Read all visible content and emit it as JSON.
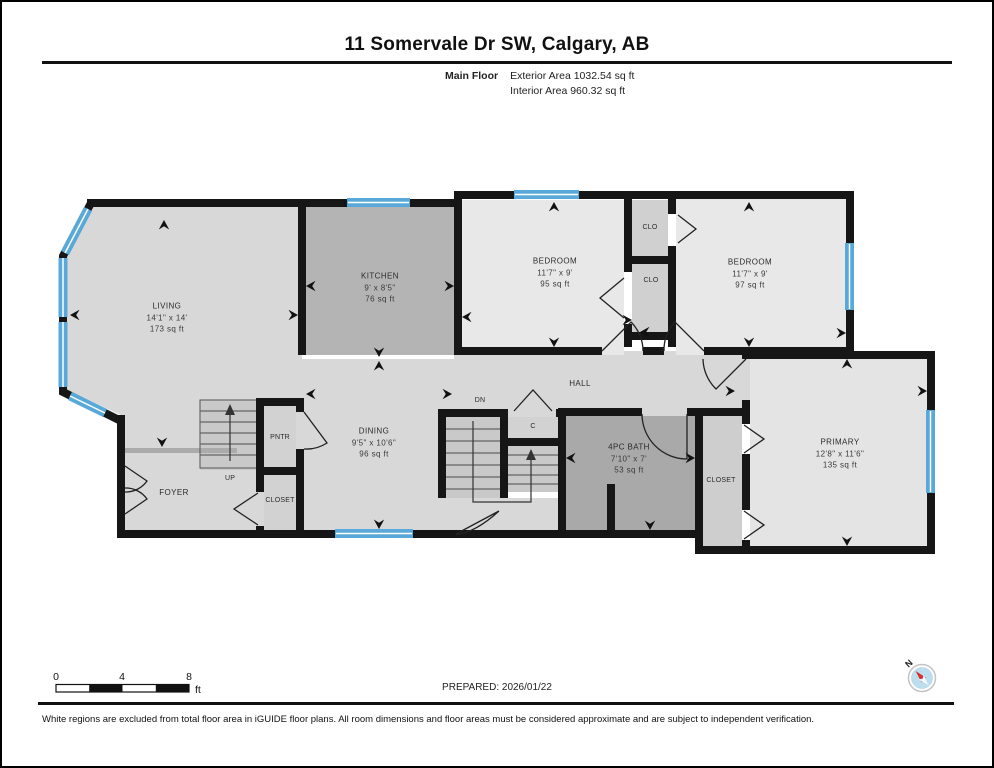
{
  "header": {
    "title": "11 Somervale Dr SW, Calgary, AB",
    "floor_label": "Main Floor",
    "exterior_area": "Exterior Area 1032.54 sq ft",
    "interior_area": "Interior Area 960.32 sq ft"
  },
  "rooms": {
    "living": {
      "name": "LIVING",
      "dims": "14'1\" x 14'",
      "area": "173 sq ft"
    },
    "kitchen": {
      "name": "KITCHEN",
      "dims": "9' x 8'5\"",
      "area": "76 sq ft"
    },
    "dining": {
      "name": "DINING",
      "dims": "9'5\" x 10'6\"",
      "area": "96 sq ft"
    },
    "foyer": {
      "name": "FOYER"
    },
    "stairs_up": {
      "name": "UP"
    },
    "pantry": {
      "name": "PNTR"
    },
    "closet_foyer": {
      "name": "CLOSET"
    },
    "bedroom_left": {
      "name": "BEDROOM",
      "dims": "11'7\" x 9'",
      "area": "95 sq ft"
    },
    "bedroom_right": {
      "name": "BEDROOM",
      "dims": "11'7\" x 9'",
      "area": "97 sq ft"
    },
    "closet_top": {
      "name": "CLO"
    },
    "closet_bottom": {
      "name": "CLO"
    },
    "hall": {
      "name": "HALL"
    },
    "stairs_dn": {
      "name": "DN"
    },
    "closet_hall": {
      "name": "C"
    },
    "bath": {
      "name": "4PC BATH",
      "dims": "7'10\" x 7'",
      "area": "53 sq ft"
    },
    "closet_primary": {
      "name": "CLOSET"
    },
    "primary": {
      "name": "PRIMARY",
      "dims": "12'8\" x 11'6\"",
      "area": "135 sq ft"
    }
  },
  "footer": {
    "scale_ticks": [
      "0",
      "4",
      "8"
    ],
    "scale_unit": "ft",
    "prepared": "PREPARED: 2026/01/22",
    "compass_label": "N",
    "disclaimer": "White regions are excluded from total floor area in iGUIDE floor plans. All room dimensions and floor areas must be considered approximate and are subject to independent verification."
  },
  "colors": {
    "wall": "#161616",
    "floor_light": "#d8d8d8",
    "floor_lighter": "#e8e8e8",
    "floor_dark": "#b4b4b4",
    "floor_darker": "#a9a9a9",
    "window_blue": "#58a9d9",
    "compass_red": "#d63030",
    "compass_blue": "#bcdeee"
  }
}
